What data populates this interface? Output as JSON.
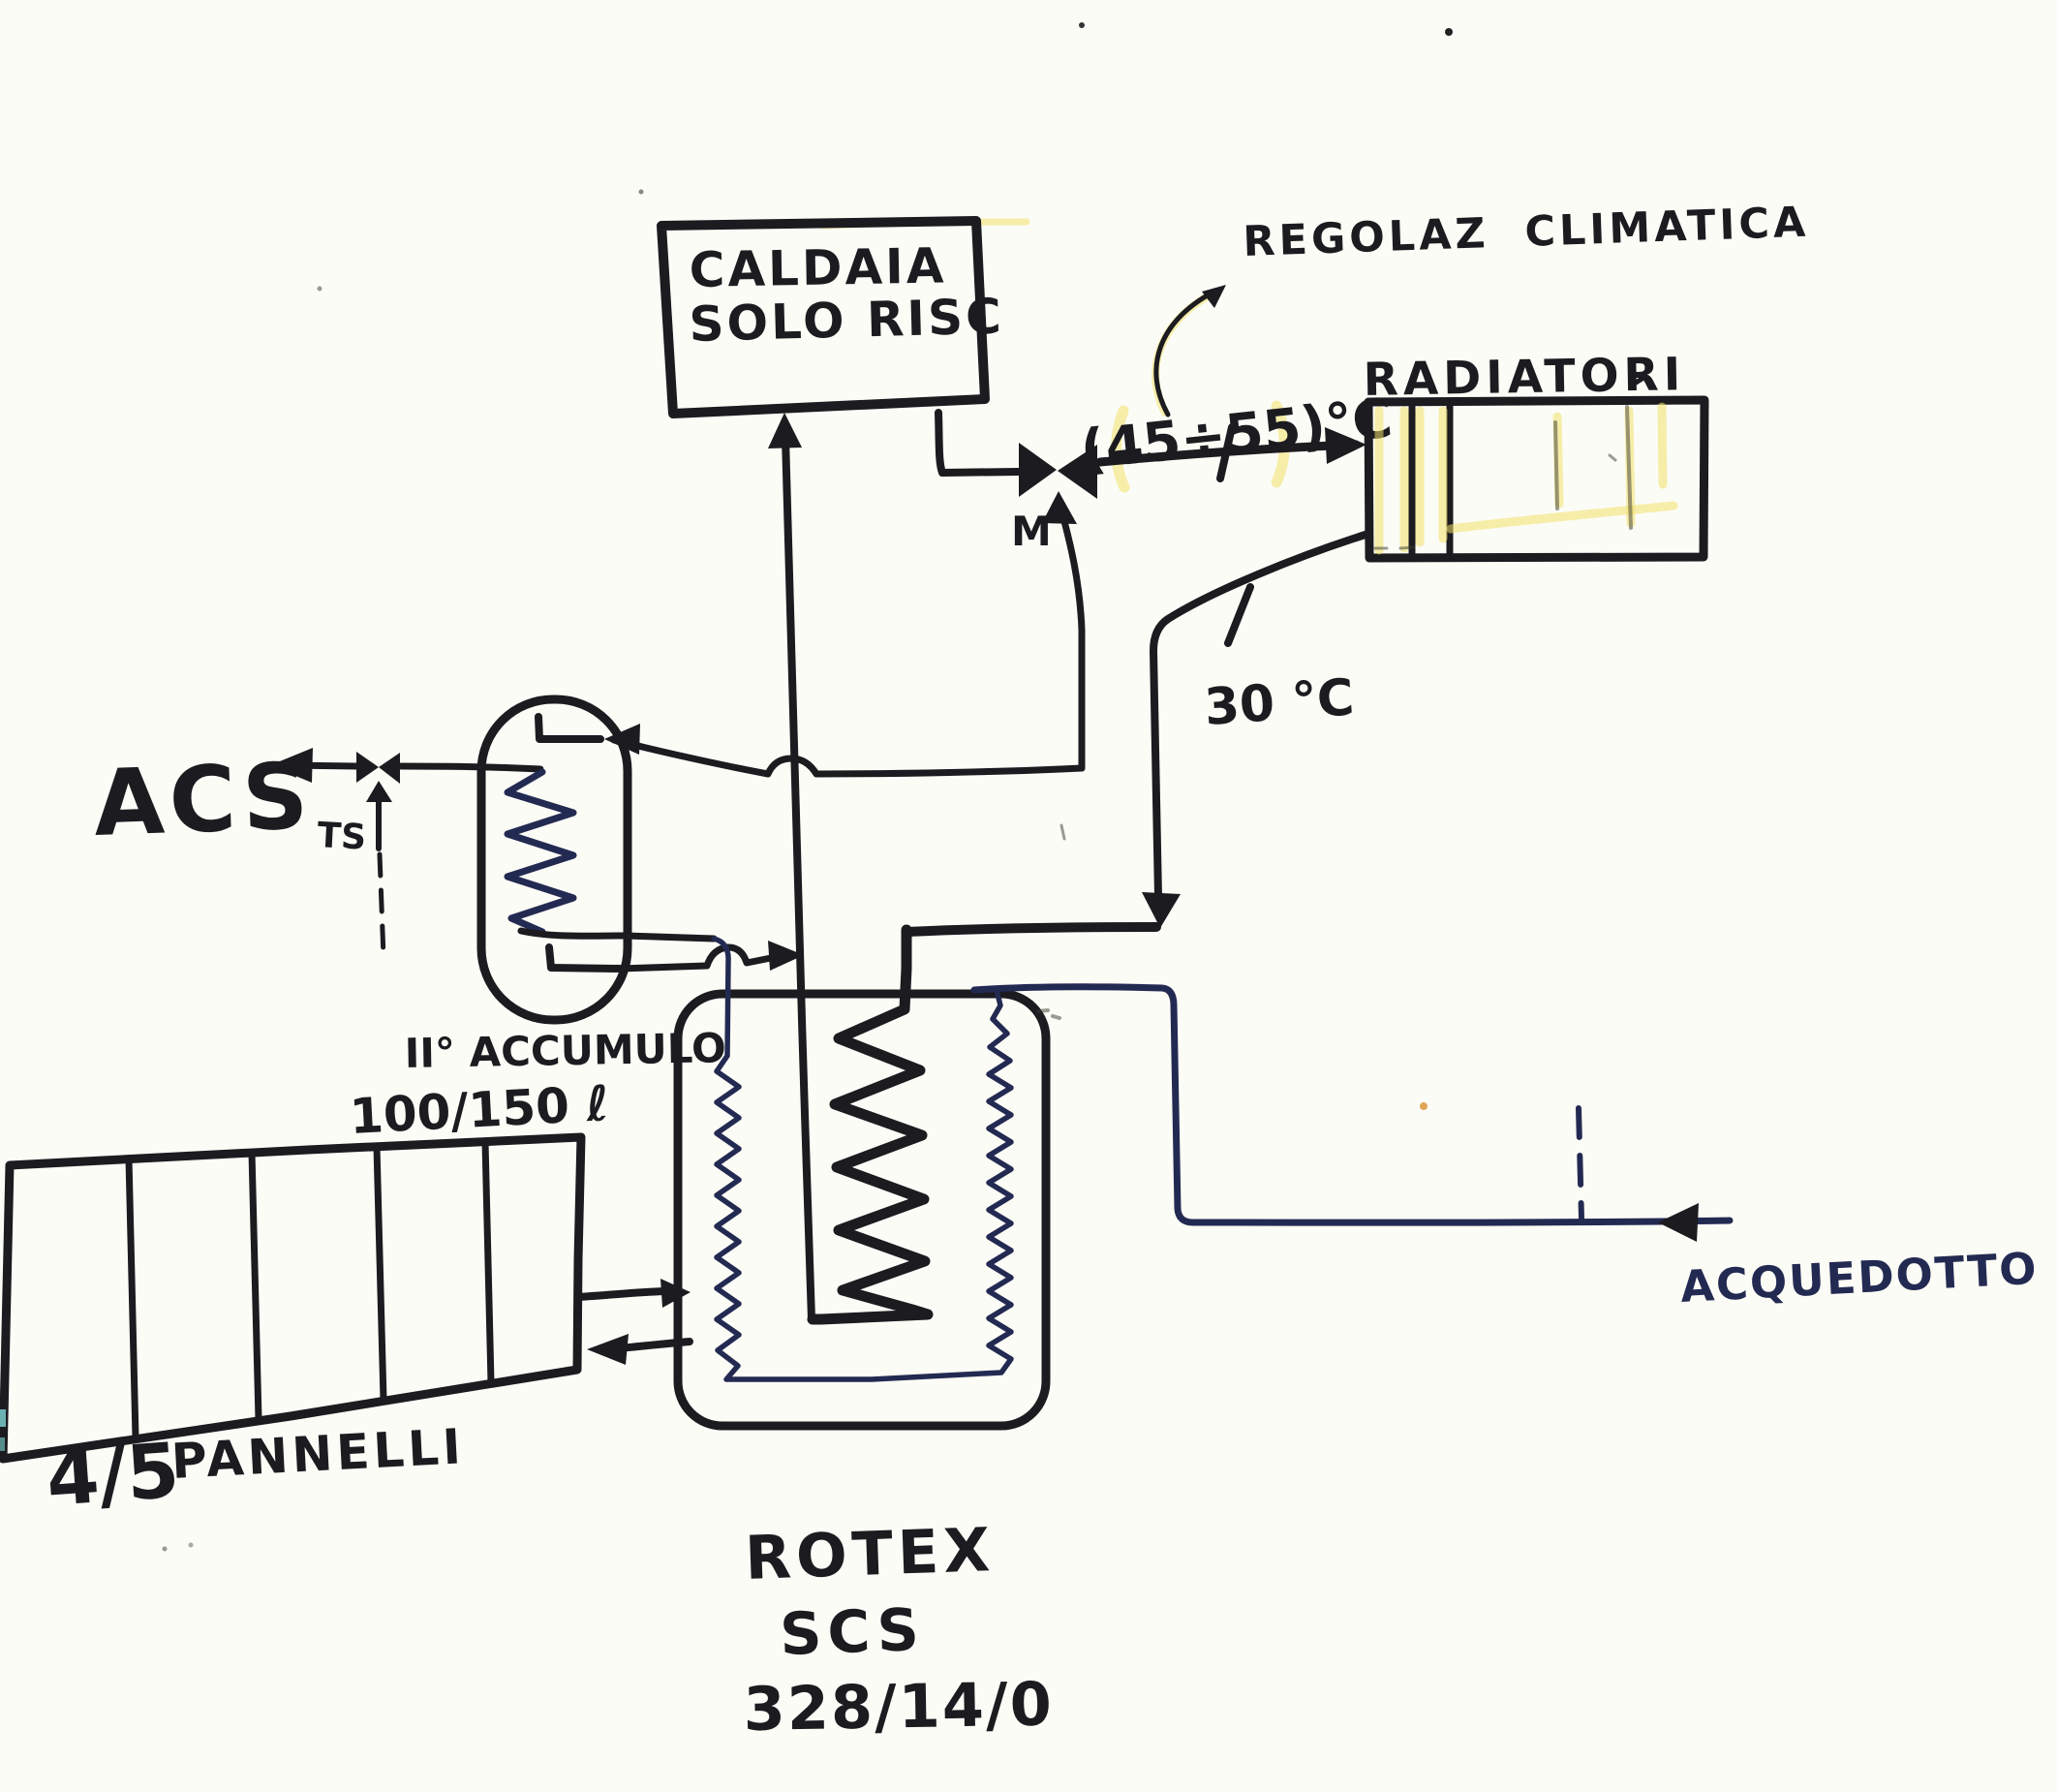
{
  "colors": {
    "ink": "#1b1b20",
    "blue": "#232a52",
    "hl": "#f0e06a",
    "paper": "#fcfcf6"
  },
  "boiler": {
    "line1": "CALDAIA",
    "line2": "SOLO RISC"
  },
  "heating_circuit": {
    "climate_note": "REGOLAZ CLIMATICA",
    "supply_temp": "(45÷55)°C",
    "radiators": "RADIATORI",
    "mixing_valve": "M",
    "return_temp": "30 °C"
  },
  "dhw": {
    "outlet": "ACS",
    "valve": "TS",
    "storage_line1": "II° ACCUMULO",
    "storage_line2": "100/150 ℓ"
  },
  "solar": {
    "panels_count": "4/5",
    "panels_word": "PANNELLI"
  },
  "tank": {
    "line1": "ROTEX",
    "line2": "SCS",
    "line3": "328/14/0"
  },
  "mains": {
    "label": "ACQUEDOTTO"
  }
}
